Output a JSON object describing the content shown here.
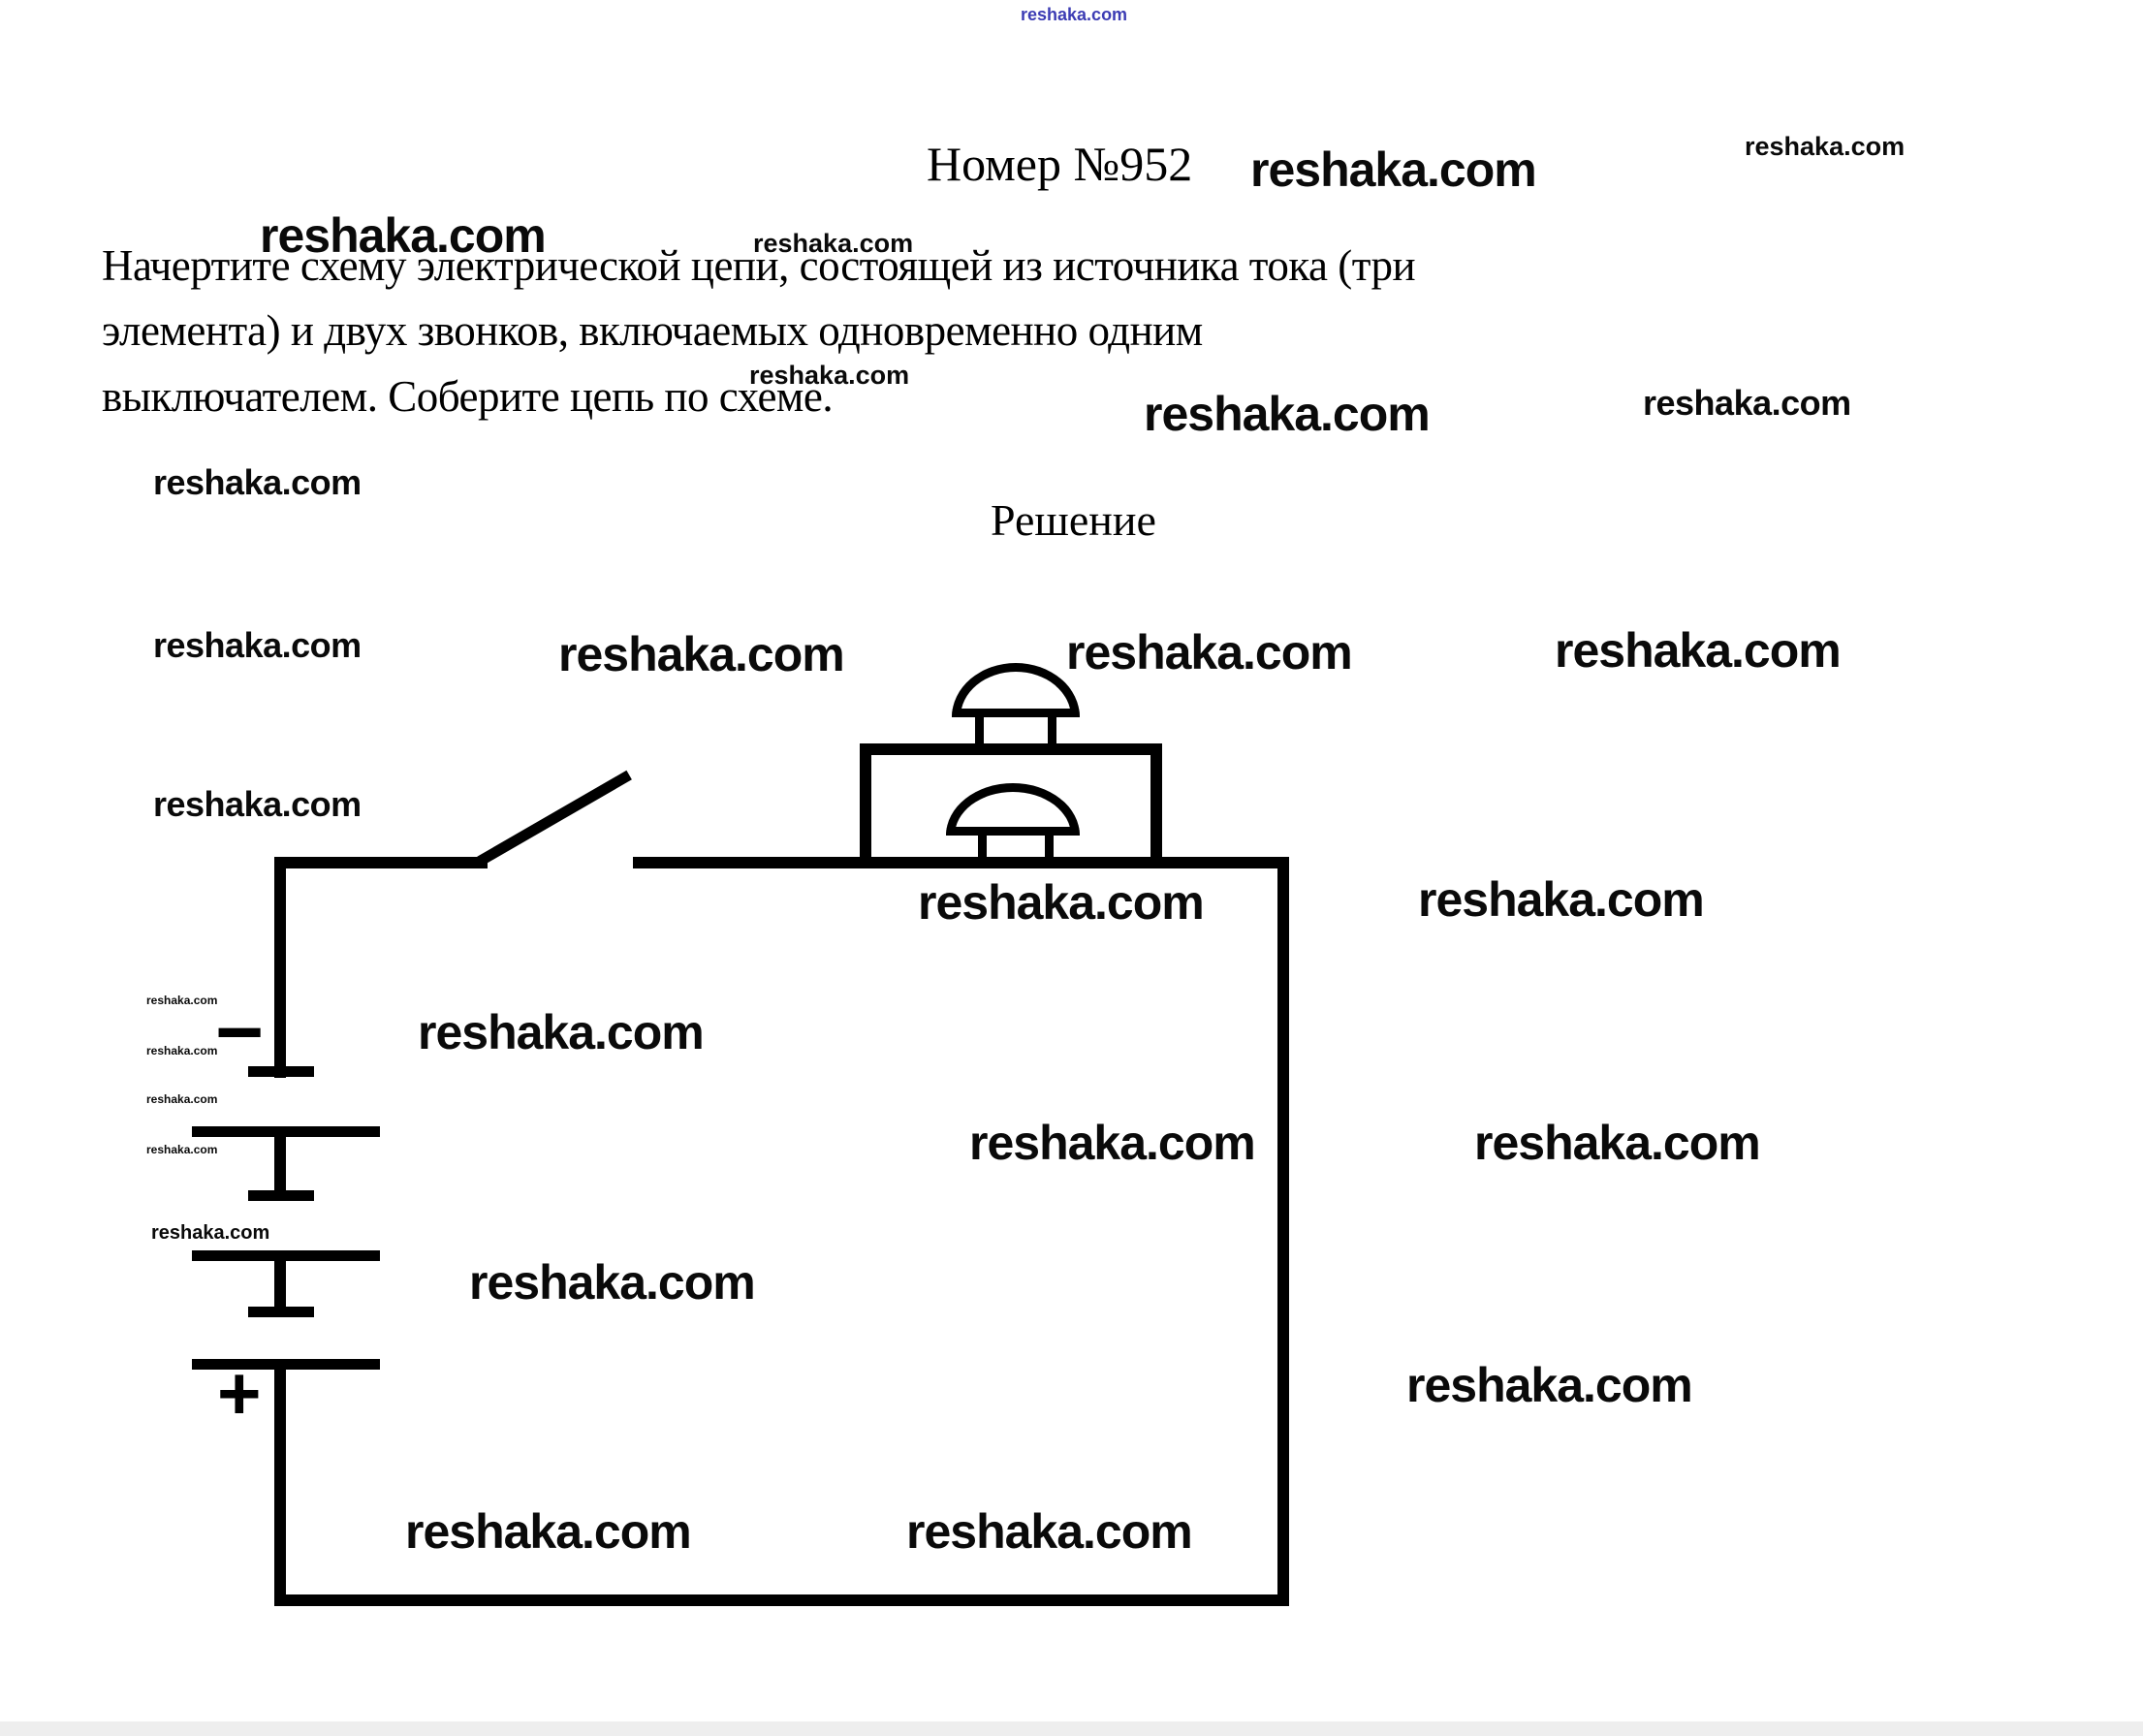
{
  "watermark": {
    "text": "reshaka.com"
  },
  "header": {
    "title": "Номер №952",
    "top_blue_watermark": "reshaka.com"
  },
  "problem": {
    "lines": [
      "Начертите схему электрической цепи, состоящей из источника тока (три",
      "элемента) и двух звонков, включаемых одновременно одним",
      "выключателем. Соберите цепь по схеме."
    ]
  },
  "solution": {
    "heading": "Решение"
  },
  "circuit": {
    "type": "schematic",
    "battery": {
      "cell_count": 3,
      "minus_label": "−",
      "plus_label": "+"
    },
    "switch_state": "open",
    "bell_count": 2
  }
}
